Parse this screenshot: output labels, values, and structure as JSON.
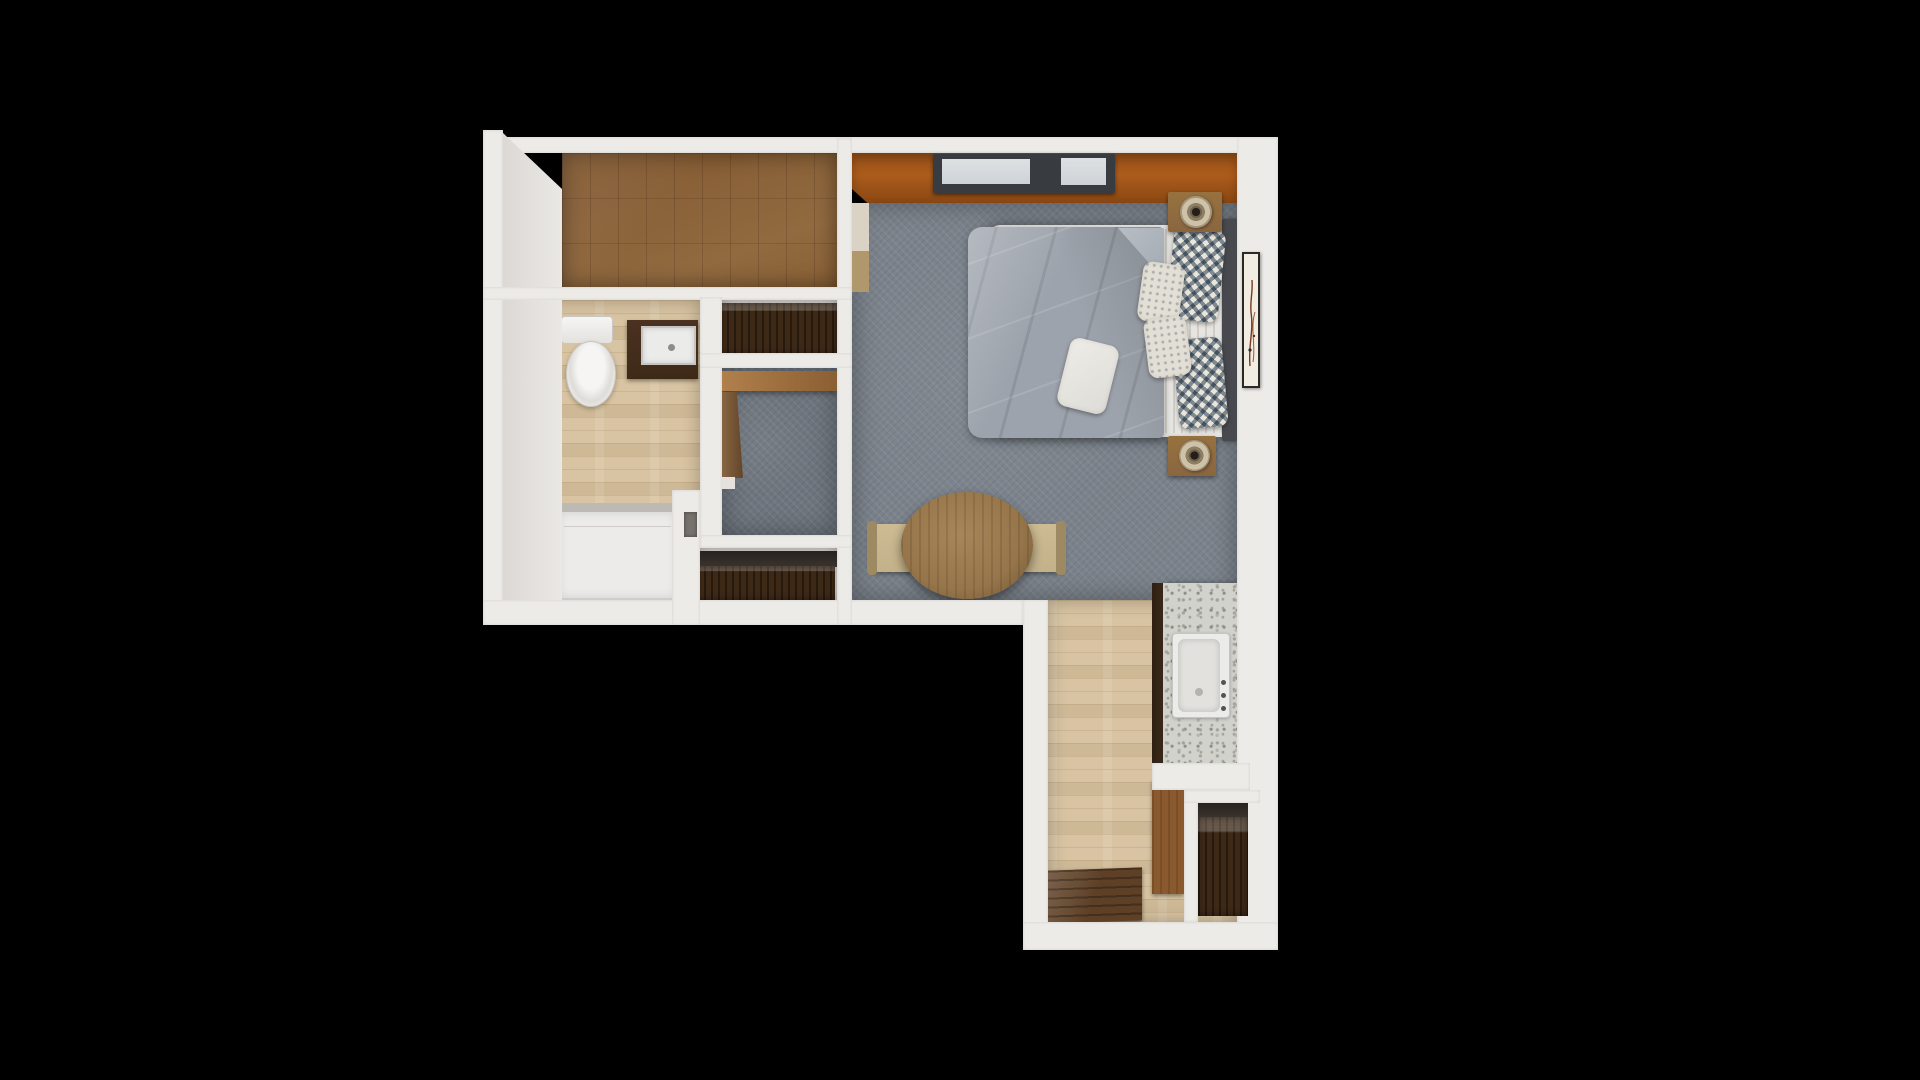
{
  "meta": {
    "title": "3D apartment floor plan — top-down render",
    "canvas": {
      "width": 1920,
      "height": 1080
    },
    "background": "#000000"
  },
  "palette": {
    "wall": "#edebe8",
    "wall-face": "#dcd9d5",
    "tile-floor": "#8a6138",
    "wood-floor": "#d8c4a2",
    "carpet": "#7b828b",
    "carpet-dark": "#6e757e",
    "orange-floor": "#ab5c1c",
    "orange-dark": "#8a4712",
    "walnut": "#3e2917",
    "cabinet-brown": "#8a5a2e",
    "granite": "#d2d2cc",
    "granite-speck": "#a3a39c",
    "granite-edge": "#3c2a1a",
    "sink": "#ebebe9",
    "sink-inner": "#e2e1de",
    "mattress": "#e7e5e1",
    "duvet": "#9da3ac",
    "headboard": "#47494e",
    "pillow-base": "#e9e5da",
    "pillow-accent": "#8a99a9",
    "nightstand": "#8a6640",
    "lamp-shade": "#cec2a8",
    "lamp-core": "#241f1a",
    "table-wood": "#96754a",
    "chair-tan": "#c3b189",
    "chair-back": "#9e8a62",
    "mat": "#5e4026",
    "window-frame": "#383b40",
    "window-glass": "#ced3d7",
    "art-paper": "#f1ede3",
    "art-frame": "#2b2926",
    "art-stroke": "#7a3a1e",
    "shower": "#ecebe9",
    "shower-rim": "#bdbab6",
    "recess": "#76726d"
  },
  "rooms": [
    {
      "id": "walk-in-closet",
      "label": "walk-in closet (brown tile floor)"
    },
    {
      "id": "bathroom",
      "label": "bathroom (toilet, vanity sink, shower tray)"
    },
    {
      "id": "dresser-nook",
      "label": "dresser alcove"
    },
    {
      "id": "study-nook",
      "label": "study nook (carpet, built-in desk)"
    },
    {
      "id": "hall-closet",
      "label": "hall closet (walnut wardrobe)"
    },
    {
      "id": "bedroom-living",
      "label": "bedroom / living area (gray carpet, orange strip at window wall)"
    },
    {
      "id": "kitchen-entry",
      "label": "kitchen / entry (wood floor, granite counter, door mat)"
    }
  ],
  "furniture": {
    "bed_mattress": {
      "x": 990,
      "y": 225,
      "w": 247,
      "h": 212
    },
    "sheet_stripes": {
      "x": 1157,
      "y": 229,
      "w": 68,
      "h": 204
    },
    "headboard": {
      "x": 1222,
      "y": 219,
      "w": 15,
      "h": 222
    },
    "duvet": {
      "x": 968,
      "y": 227,
      "w": 196,
      "h": 211
    },
    "duvet_fold": {
      "x": 1118,
      "y": 228,
      "w": 46,
      "h": 52
    },
    "pillow_chevron_1": {
      "x": 1170,
      "y": 229,
      "w": 52,
      "h": 92,
      "r": 6
    },
    "pillow_chevron_2": {
      "x": 1176,
      "y": 338,
      "w": 49,
      "h": 90,
      "r": -5
    },
    "pillow_leaf_1": {
      "x": 1140,
      "y": 263,
      "w": 42,
      "h": 60,
      "r": 8
    },
    "pillow_leaf_2": {
      "x": 1146,
      "y": 317,
      "w": 43,
      "h": 60,
      "r": -7
    },
    "pillow_plain": {
      "x": 1063,
      "y": 341,
      "w": 50,
      "h": 70,
      "r": 14
    },
    "nightstand_top": {
      "x": 1168,
      "y": 192,
      "w": 54,
      "h": 40
    },
    "lamp_top": {
      "x": 1180,
      "y": 196,
      "w": 32,
      "h": 32
    },
    "nightstand_bottom": {
      "x": 1168,
      "y": 436,
      "w": 48,
      "h": 40
    },
    "lamp_bottom": {
      "x": 1179,
      "y": 440,
      "w": 31,
      "h": 31
    },
    "wall_art": {
      "x": 1242,
      "y": 252,
      "w": 18,
      "h": 136
    },
    "window": {
      "x": 933,
      "y": 154,
      "w": 182,
      "h": 39
    },
    "bedroom_wardrobe_top": {
      "x": 852,
      "y": 203,
      "w": 17,
      "h": 48
    },
    "bedroom_wardrobe_bottom": {
      "x": 852,
      "y": 251,
      "w": 17,
      "h": 41
    },
    "dresser": {
      "x": 720,
      "y": 303,
      "w": 117,
      "h": 51
    },
    "desk_band": {
      "x": 722,
      "y": 371,
      "w": 115,
      "h": 20
    },
    "side_panel": {
      "x": 715,
      "y": 392,
      "w": 28,
      "h": 86
    },
    "panel_ledge": {
      "x": 715,
      "y": 477,
      "w": 20,
      "h": 12
    },
    "closet_dark_band": {
      "x": 697,
      "y": 551,
      "w": 140,
      "h": 16
    },
    "closet_wardrobe": {
      "x": 697,
      "y": 566,
      "w": 138,
      "h": 34
    },
    "door_recess": {
      "x": 684,
      "y": 512,
      "w": 13,
      "h": 25
    },
    "toilet_tank": {
      "x": 561,
      "y": 316,
      "w": 52,
      "h": 28
    },
    "toilet_bowl": {
      "x": 566,
      "y": 341,
      "w": 50,
      "h": 66
    },
    "vanity_cabinet": {
      "x": 627,
      "y": 320,
      "w": 71,
      "h": 59
    },
    "vanity_counter": {
      "x": 641,
      "y": 326,
      "w": 55,
      "h": 39
    },
    "vanity_drain": {
      "x": 668,
      "y": 344,
      "w": 7,
      "h": 7
    },
    "shower_tray": {
      "x": 557,
      "y": 503,
      "w": 121,
      "h": 97
    },
    "dining_table": {
      "x": 901,
      "y": 492,
      "w": 132,
      "h": 107
    },
    "chair_left": {
      "x": 869,
      "y": 524,
      "w": 45,
      "h": 48
    },
    "chair_right": {
      "x": 1019,
      "y": 524,
      "w": 45,
      "h": 48
    },
    "counter_edge": {
      "x": 1152,
      "y": 583,
      "w": 11,
      "h": 180
    },
    "counter_granite": {
      "x": 1163,
      "y": 583,
      "w": 74,
      "h": 180
    },
    "kitchen_sink": {
      "x": 1172,
      "y": 633,
      "w": 58,
      "h": 85
    },
    "tall_cabinet": {
      "x": 1152,
      "y": 780,
      "w": 32,
      "h": 114
    },
    "niche_unit_top": {
      "x": 1198,
      "y": 803,
      "w": 50,
      "h": 15
    },
    "niche_unit": {
      "x": 1198,
      "y": 817,
      "w": 50,
      "h": 99
    },
    "entry_mat": {
      "x": 1048,
      "y": 869,
      "w": 94,
      "h": 53
    }
  }
}
